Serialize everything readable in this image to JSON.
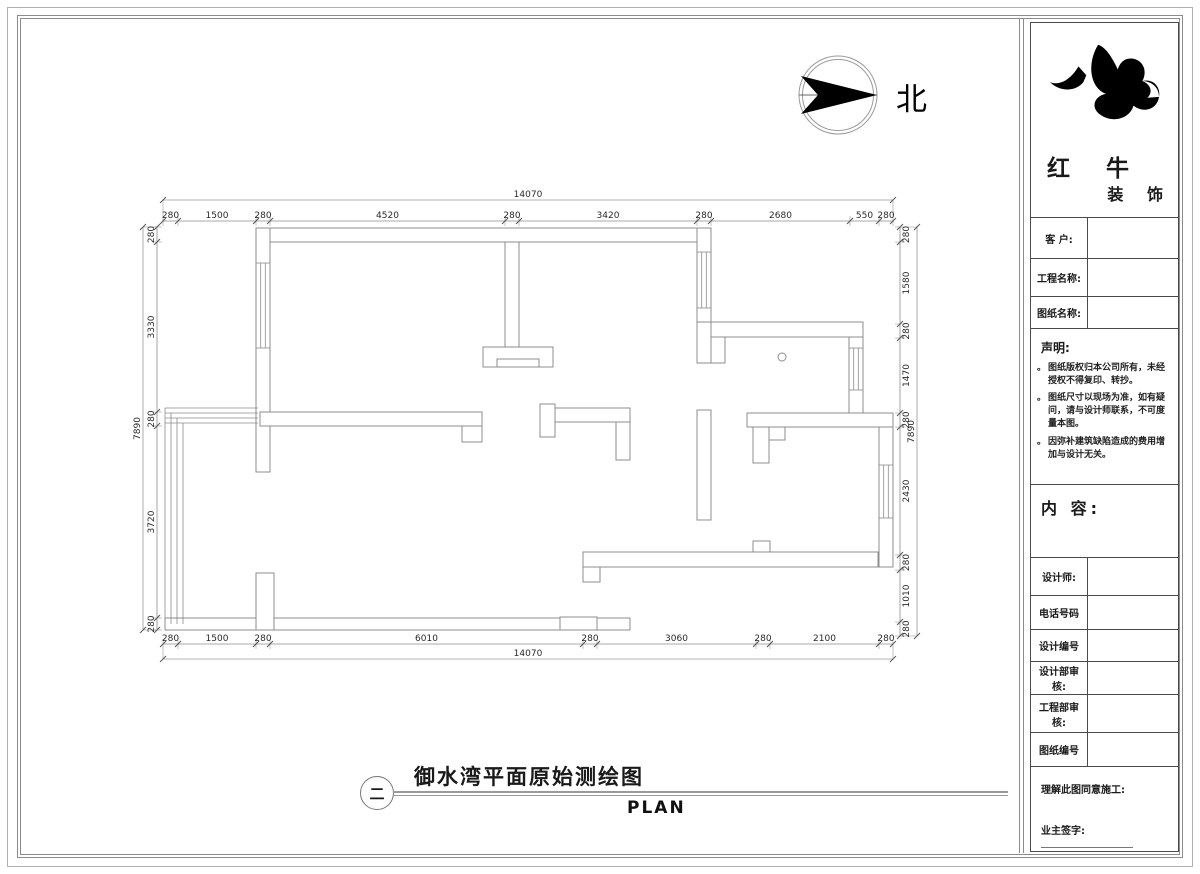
{
  "north": {
    "label": "北"
  },
  "logo": {
    "company": "红 牛",
    "suffix": "装 饰"
  },
  "titleblock": {
    "customer_label": "客 户:",
    "project_label": "工程名称:",
    "drawing_name_label": "图纸名称:",
    "statement": {
      "title": "声明:",
      "items": [
        "图纸版权归本公司所有，未经授权不得复印、转抄。",
        "图纸尺寸以现场为准，如有疑问，请与设计师联系，不可度量本图。",
        "因弥补建筑缺陷造成的费用增加与设计无关。"
      ]
    },
    "content_label": "内 容:",
    "designer_label": "设计师:",
    "phone_label": "电话号码",
    "design_no_label": "设计编号",
    "design_audit_label": "设计部审核:",
    "eng_audit_label": "工程部审核:",
    "drawing_no_label": "图纸编号",
    "approve_label": "理解此图同意施工:",
    "sign_label": "业主签字:"
  },
  "footer": {
    "index": "二",
    "title": "御水湾平面原始测绘图",
    "subtitle": "PLAN"
  },
  "plan": {
    "dims": {
      "top": {
        "overall": "14070",
        "segments": [
          "280",
          "1500",
          "280",
          "4520",
          "280",
          "3420",
          "280",
          "2680",
          "550",
          "280"
        ]
      },
      "bottom": {
        "overall": "14070",
        "segments": [
          "280",
          "1500",
          "280",
          "6010",
          "280",
          "3060",
          "280",
          "2100",
          "280"
        ]
      },
      "left": {
        "overall": "7890",
        "segments": [
          "280",
          "3330",
          "280",
          "3720",
          "280"
        ]
      },
      "right": {
        "overall": "7890",
        "segments": [
          "280",
          "1580",
          "280",
          "1470",
          "280",
          "2430",
          "280",
          "1010",
          "280"
        ]
      }
    }
  }
}
